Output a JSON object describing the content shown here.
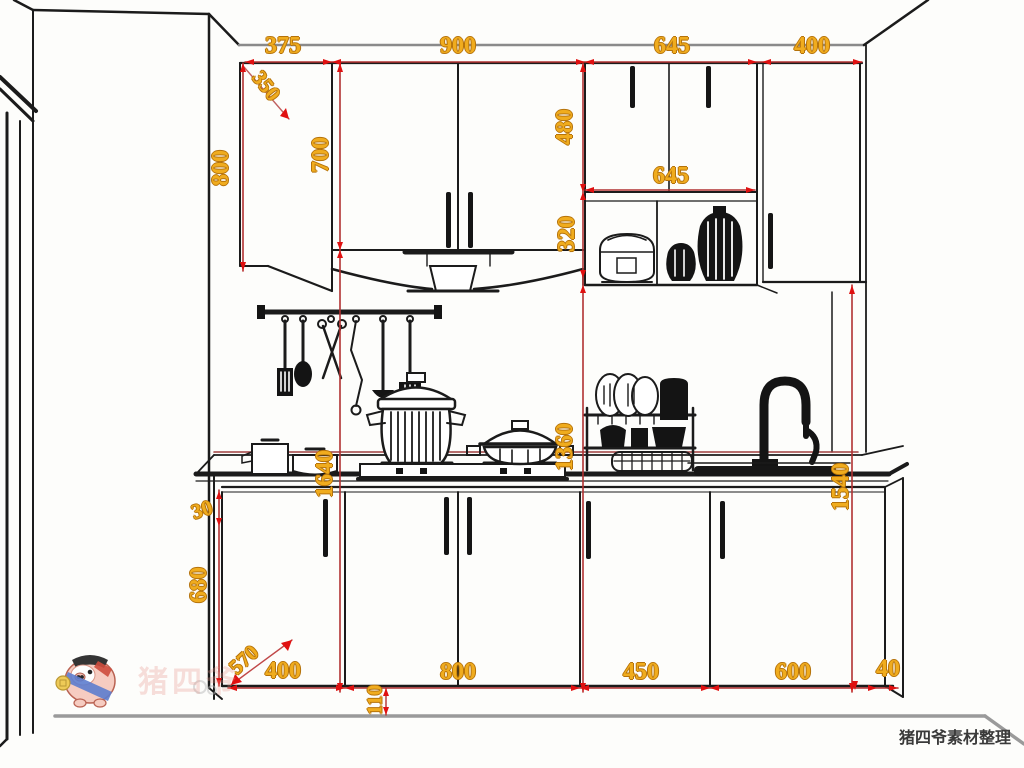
{
  "drawing": {
    "title": "kitchen-elevation",
    "credit": "猪四爷素材整理",
    "watermark_text": "猪四爷",
    "colors": {
      "dimension_text": "#f0ac1e",
      "dimension_line": "#b13232",
      "arrow": "#e01010",
      "line_art": "#1b1b1b",
      "floor_line": "#9a9a9a"
    },
    "dimensions": {
      "upper_row_widths": [
        "375",
        "900",
        "645",
        "400"
      ],
      "corner_diagonal": "350",
      "upper_left_height": "800",
      "upper_mid_height": "700",
      "upper_right_height": "480",
      "shelf_width": "645",
      "shelf_height": "320",
      "counter_height_left": "1640",
      "counter_height_mid": "1360",
      "counter_height_right": "1540",
      "counter_gap": "30",
      "base_height": "680",
      "base_diagonal": "570",
      "base_row_widths": [
        "400",
        "800",
        "450",
        "600",
        "40"
      ],
      "toe_kick_height": "110"
    }
  }
}
